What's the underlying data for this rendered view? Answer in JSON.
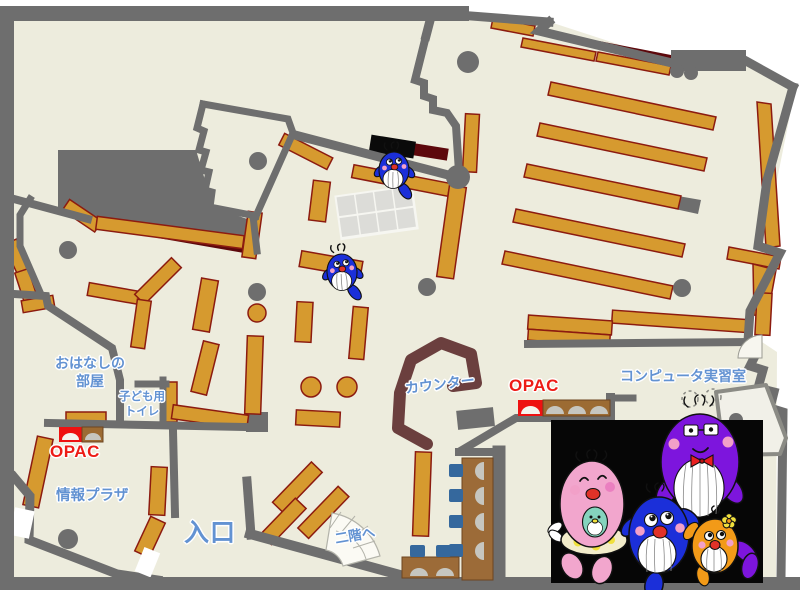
{
  "labels": {
    "story_room_line1": "おはなしの",
    "story_room_line2": "部屋",
    "kids_toilet_line1": "子ども用",
    "kids_toilet_line2": "トイレ",
    "opac_left": "OPAC",
    "opac_right": "OPAC",
    "info_plaza": "情報プラザ",
    "entrance": "入口",
    "counter": "カウンター",
    "computer_room": "コンピュータ実習室",
    "stairs_up": "二階へ"
  },
  "icons": {
    "map_markers": [
      "whale-mascot",
      "whale-mascot"
    ],
    "mascot_family": [
      "pink-whale-mascot",
      "blue-whale-mascot",
      "purple-whale-mascot",
      "orange-whale-mascot"
    ]
  },
  "colors": {
    "floor": "#edecdd",
    "wall": "#6e6e6e",
    "shelf": "#d69a2f",
    "shelf_border": "#8c1b10",
    "dark_red": "#5d080c",
    "counter": "#6b3f3e",
    "table_brown": "#9c6b38",
    "chair_blue": "#35689d",
    "seat_gray": "#c6c6c0",
    "grid_cell": "#dcdcd8",
    "grid_gap": "#f6f6f1",
    "machine_red": "#ee1111",
    "machine_brown": "#9c6b33",
    "label_blue": "#6292d2",
    "label_red": "#ed1c16",
    "belly_white": "#ffffff",
    "cheek_pink": "#f2a0c8",
    "mouth_red": "#e03228",
    "whale_blue": "#1b2fd9",
    "whale_pink": "#f2a6cd",
    "whale_purple": "#7d15dd",
    "whale_orange": "#f29a18",
    "whale_teal": "#85d4be",
    "skirt_cream": "#f2ecca",
    "flower_yellow": "#f0e03c"
  }
}
